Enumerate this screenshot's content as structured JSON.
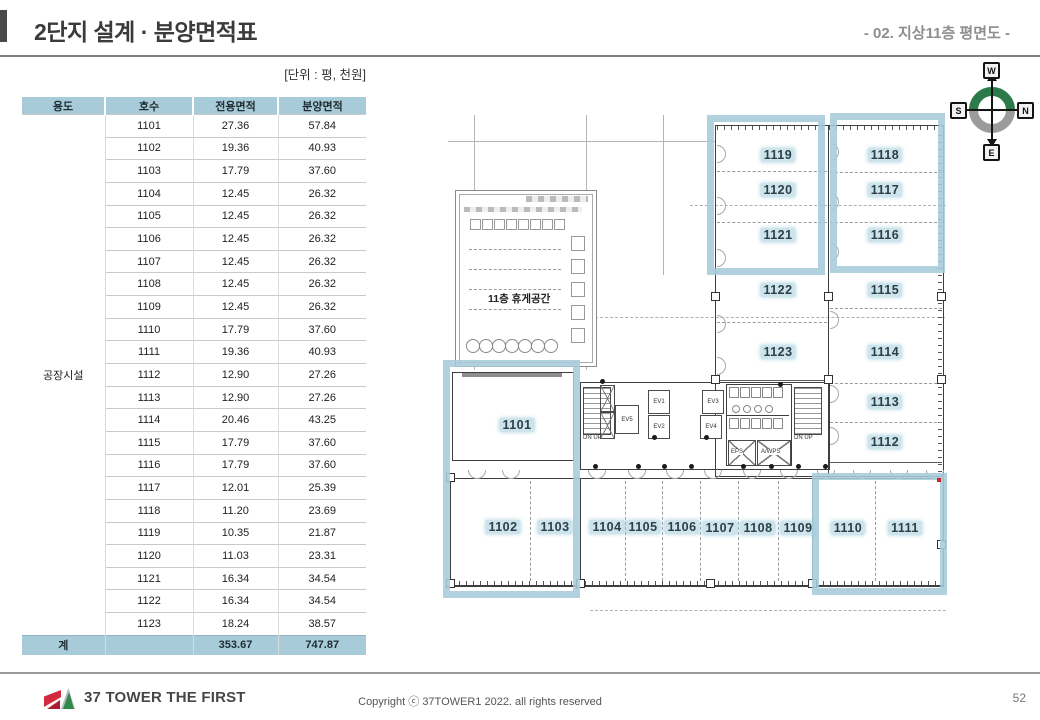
{
  "header": {
    "title": "2단지 설계 · 분양면적표",
    "subtitle": "- 02. 지상11층 평면도 -"
  },
  "table": {
    "unit_note": "[단위 : 평, 천원]",
    "columns": [
      "용도",
      "호수",
      "전용면적",
      "분양면적"
    ],
    "usage_label": "공장시설",
    "rows": [
      [
        "1101",
        "27.36",
        "57.84"
      ],
      [
        "1102",
        "19.36",
        "40.93"
      ],
      [
        "1103",
        "17.79",
        "37.60"
      ],
      [
        "1104",
        "12.45",
        "26.32"
      ],
      [
        "1105",
        "12.45",
        "26.32"
      ],
      [
        "1106",
        "12.45",
        "26.32"
      ],
      [
        "1107",
        "12.45",
        "26.32"
      ],
      [
        "1108",
        "12.45",
        "26.32"
      ],
      [
        "1109",
        "12.45",
        "26.32"
      ],
      [
        "1110",
        "17.79",
        "37.60"
      ],
      [
        "1111",
        "19.36",
        "40.93"
      ],
      [
        "1112",
        "12.90",
        "27.26"
      ],
      [
        "1113",
        "12.90",
        "27.26"
      ],
      [
        "1114",
        "20.46",
        "43.25"
      ],
      [
        "1115",
        "17.79",
        "37.60"
      ],
      [
        "1116",
        "17.79",
        "37.60"
      ],
      [
        "1117",
        "12.01",
        "25.39"
      ],
      [
        "1118",
        "11.20",
        "23.69"
      ],
      [
        "1119",
        "10.35",
        "21.87"
      ],
      [
        "1120",
        "11.03",
        "23.31"
      ],
      [
        "1121",
        "16.34",
        "34.54"
      ],
      [
        "1122",
        "16.34",
        "34.54"
      ],
      [
        "1123",
        "18.24",
        "38.57"
      ]
    ],
    "total": {
      "label": "계",
      "unit_cell": "",
      "exclusive": "353.67",
      "sale": "747.87"
    }
  },
  "plan": {
    "rest_area_label": "11층 휴게공간",
    "core_labels": {
      "stair_left": "DN  UP",
      "stair_right": "DN  UP",
      "ev1": "EV1",
      "ev2": "EV2",
      "ev3": "EV3",
      "ev4": "EV4",
      "ev5": "EV5",
      "eps": "EPS",
      "awps": "A/WPS"
    },
    "rooms": [
      {
        "id": "1101",
        "x": 77,
        "y": 340
      },
      {
        "id": "1102",
        "x": 63,
        "y": 442
      },
      {
        "id": "1103",
        "x": 115,
        "y": 442
      },
      {
        "id": "1104",
        "x": 167,
        "y": 442
      },
      {
        "id": "1105",
        "x": 203,
        "y": 442
      },
      {
        "id": "1106",
        "x": 242,
        "y": 442
      },
      {
        "id": "1107",
        "x": 280,
        "y": 443
      },
      {
        "id": "1108",
        "x": 318,
        "y": 443
      },
      {
        "id": "1109",
        "x": 358,
        "y": 443
      },
      {
        "id": "1110",
        "x": 408,
        "y": 443
      },
      {
        "id": "1111",
        "x": 465,
        "y": 443
      },
      {
        "id": "1112",
        "x": 445,
        "y": 357
      },
      {
        "id": "1113",
        "x": 445,
        "y": 317
      },
      {
        "id": "1114",
        "x": 445,
        "y": 267
      },
      {
        "id": "1115",
        "x": 445,
        "y": 205
      },
      {
        "id": "1116",
        "x": 445,
        "y": 150
      },
      {
        "id": "1117",
        "x": 445,
        "y": 105
      },
      {
        "id": "1118",
        "x": 445,
        "y": 70
      },
      {
        "id": "1119",
        "x": 338,
        "y": 70
      },
      {
        "id": "1120",
        "x": 338,
        "y": 105
      },
      {
        "id": "1121",
        "x": 338,
        "y": 150
      },
      {
        "id": "1122",
        "x": 338,
        "y": 205
      },
      {
        "id": "1123",
        "x": 338,
        "y": 267
      }
    ],
    "highlight_blocks": [
      {
        "x": 267,
        "y": 30,
        "w": 118,
        "h": 160
      },
      {
        "x": 390,
        "y": 28,
        "w": 115,
        "h": 160
      },
      {
        "x": 3,
        "y": 275,
        "w": 137,
        "h": 238
      },
      {
        "x": 372,
        "y": 388,
        "w": 135,
        "h": 122
      }
    ]
  },
  "compass": {
    "top": "W",
    "right": "N",
    "bottom": "E",
    "left": "S"
  },
  "footer": {
    "brand": "37 TOWER THE FIRST",
    "copyright": "Copyright ⓒ 37TOWER1 2022. all rights reserved",
    "page": "52"
  }
}
